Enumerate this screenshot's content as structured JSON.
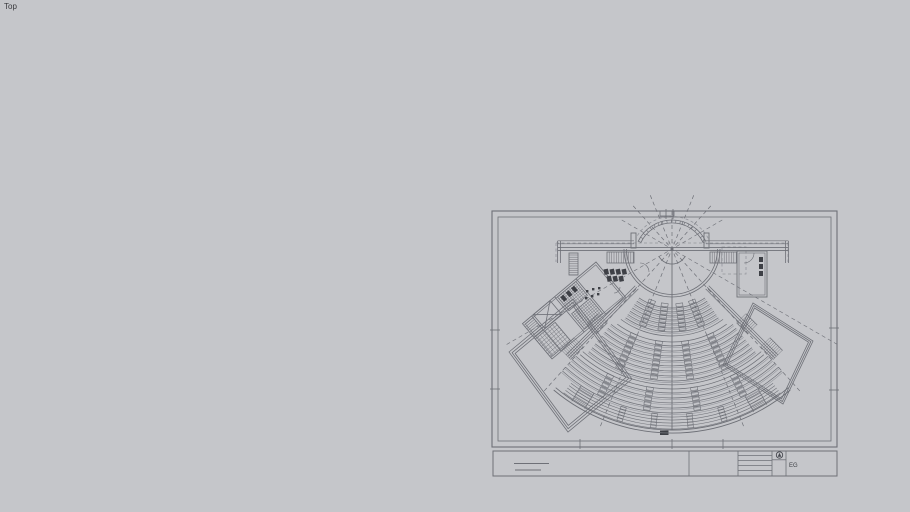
{
  "viewport": {
    "label": "Top"
  },
  "colors": {
    "background": "#c5c6ca",
    "line": "#6e7077",
    "line_light": "#93959c",
    "line_dark": "#46484f",
    "fill_dark": "#3e4046",
    "text": "#3a3a3e"
  },
  "sheet": {
    "frame": {
      "outer": [
        492,
        211,
        345,
        236
      ],
      "inner": [
        498,
        217,
        333,
        224
      ],
      "ticks": {
        "top": [
          666,
          673
        ],
        "bottom": [
          580,
          672,
          723
        ],
        "left": [
          330,
          389
        ],
        "right": [
          328,
          390
        ]
      }
    },
    "title_block": {
      "strip": [
        493,
        451,
        344,
        25
      ],
      "dividers_x": [
        689,
        738,
        772,
        786
      ],
      "revision_rows_y": [
        455.5,
        460.5,
        465.5,
        470.5
      ],
      "revision_x": [
        738,
        772
      ],
      "left_cell_lines": [
        [
          514,
          463.5,
          549
        ],
        [
          515,
          470,
          541
        ]
      ],
      "north_symbol": {
        "cx": 779.5,
        "cy": 455,
        "r": 3.2
      },
      "label": "EG"
    }
  },
  "plan": {
    "center": [
      672,
      249
    ],
    "radial_angles": [
      -60,
      -42,
      -22,
      22,
      42,
      60
    ],
    "center_line": {
      "top": 211,
      "bottom": 430,
      "foot": [
        660,
        430.5,
        8.5,
        4.5
      ]
    },
    "tiers": [
      {
        "rows": [
          59,
          63,
          67,
          71,
          75,
          79,
          83
        ],
        "span": 34,
        "desk_angles": [
          -21,
          -7.5,
          7.5,
          21
        ]
      },
      {
        "rows": [
          97,
          102,
          107,
          112,
          117,
          122,
          127,
          132
        ],
        "span": 39,
        "desk_angles": [
          -24,
          -8,
          8,
          24
        ]
      },
      {
        "rows": [
          144,
          149,
          154,
          159,
          164
        ],
        "span": 42,
        "desk_angles": [
          -26,
          -9,
          9,
          26
        ]
      }
    ],
    "aisle_arcs": [
      {
        "radii": [
          87,
          93
        ],
        "span": 36
      },
      {
        "radii": [
          136,
          140
        ],
        "span": 41
      }
    ],
    "gallery": {
      "rows": [
        168,
        171,
        174,
        177,
        180
      ],
      "span": 37,
      "desk_angles": [
        -17,
        -6,
        6,
        17
      ]
    },
    "boundary": {
      "radii": [
        181,
        184
      ],
      "span": 40
    },
    "side_walls": {
      "angles": [
        -45,
        45
      ],
      "r1": 52,
      "r2": 150,
      "offsets": [
        0,
        2.2,
        4.4
      ]
    },
    "stage": {
      "cy_back": 257.5,
      "back_radii": [
        34.5,
        37.5
      ],
      "back_span": [
        115,
        245
      ],
      "tick_step": 7,
      "roof_arc": 41,
      "front_radii": [
        45.5,
        48
      ],
      "podium_r": 15,
      "pilasters": [
        [
          631,
          233,
          5,
          15
        ],
        [
          704,
          233,
          5,
          15
        ]
      ],
      "side_hatches": [
        [
          607,
          252,
          27,
          11
        ],
        [
          710,
          252,
          27,
          11
        ]
      ],
      "wall_y": [
        247.6,
        250.6
      ],
      "wall_x": [
        558,
        788
      ],
      "upper_wall_y": [
        240.8,
        243.8
      ],
      "upper_wall_segs": [
        [
          558,
          634
        ],
        [
          706,
          788
        ]
      ],
      "end_walls": [
        [
          557.5,
          560.5
        ],
        [
          785.5,
          788.5
        ]
      ],
      "end_wall_drop": 263,
      "border_tick_rect": [
        660,
        211,
        14,
        5
      ]
    },
    "wall_hatches": [
      {
        "angle": -45,
        "r1": 98,
        "r2": 114
      },
      {
        "angle": 45,
        "r1": 98,
        "r2": 114
      },
      {
        "angle": -45,
        "r1": 132,
        "r2": 150
      },
      {
        "angle": 45,
        "r1": 132,
        "r2": 150
      }
    ],
    "outer_stairs": [
      {
        "angle": -31,
        "r1": 164,
        "r2": 182
      },
      {
        "angle": 29,
        "r1": 164,
        "r2": 182
      }
    ],
    "hatch_halfwidth": 6.5,
    "pavilions": [
      {
        "points": [
          [
            509,
            352
          ],
          [
            573,
            299
          ],
          [
            632,
            379
          ],
          [
            568,
            432
          ]
        ]
      },
      {
        "points": [
          [
            753,
            303
          ],
          [
            813,
            341
          ],
          [
            783,
            404
          ],
          [
            723,
            365
          ]
        ]
      }
    ],
    "annex": {
      "anchor": [
        596,
        262
      ],
      "rotation": -40,
      "outline": [
        -96,
        0,
        96,
        46
      ],
      "dividers": [
        -26,
        -54,
        -84
      ],
      "grids": [
        {
          "r": [
            -52,
            2,
            24,
            18
          ],
          "cell": 2.4
        },
        {
          "r": [
            -52,
            24,
            24,
            20
          ],
          "cell": 2.4
        },
        {
          "r": [
            -96,
            20,
            26,
            24
          ],
          "cell": 3.2
        }
      ],
      "xbox": [
        -82,
        0,
        22,
        18
      ],
      "hatch": [
        -96,
        0,
        12,
        18
      ],
      "dark_cells": [
        [
          -50,
          4
        ],
        [
          -43,
          4
        ],
        [
          -36,
          4
        ]
      ],
      "cell_size": [
        4,
        6
      ]
    },
    "entry_hatch": [
      569,
      253,
      9,
      22
    ],
    "right_room": {
      "rect": [
        737,
        251,
        30,
        46
      ],
      "door": {
        "cx": 744,
        "cy": 253,
        "r": 10,
        "a1": 0,
        "a2": 90
      },
      "fixtures": [
        [
          759,
          257
        ],
        [
          759,
          264
        ],
        [
          759,
          271
        ]
      ]
    },
    "door_arcs": [
      {
        "cx": 640,
        "cy": 272,
        "r": 9,
        "a1": 90,
        "a2": 180
      },
      {
        "cx": 614,
        "cy": 287,
        "r": 6,
        "a1": 0,
        "a2": 90
      }
    ],
    "foyer_fixtures": {
      "cells": [
        [
          604,
          269
        ],
        [
          610,
          269
        ],
        [
          616,
          269
        ],
        [
          622,
          269
        ],
        [
          607,
          276
        ],
        [
          613,
          276
        ],
        [
          619,
          276
        ]
      ],
      "size": [
        4.5,
        5.5
      ],
      "rotation": -12
    },
    "furniture_dots": [
      [
        586,
        290
      ],
      [
        592,
        288
      ],
      [
        598,
        287
      ],
      [
        585,
        297
      ],
      [
        591,
        295
      ],
      [
        597,
        293
      ]
    ],
    "dashed_roof": {
      "top": [
        556,
        243,
        788
      ],
      "drops": [
        [
          556,
          243,
          262
        ],
        [
          788,
          243,
          262
        ]
      ],
      "box": [
        722,
        247,
        24,
        27
      ]
    }
  }
}
